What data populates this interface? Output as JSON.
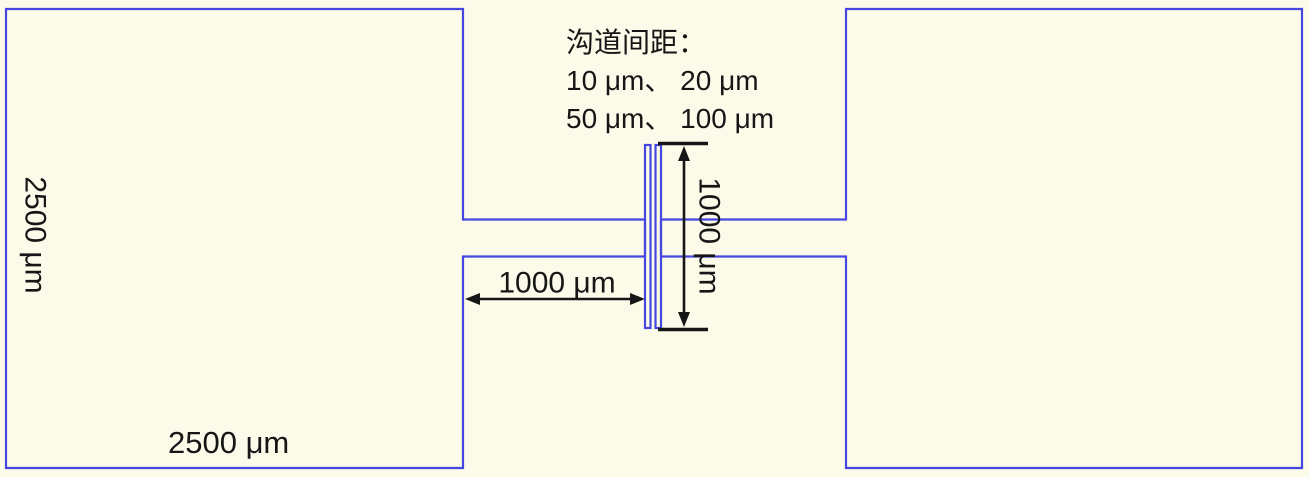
{
  "figure": {
    "title_hint": "microfabricated two-pad electrode layout with channel gap",
    "colors": {
      "background": "#fcfae8",
      "outline": "#4646e0",
      "ink": "#161616"
    }
  },
  "note": {
    "line1": "沟道间距：",
    "line2": "10 μm、 20 μm",
    "line3": "50 μm、 100 μm"
  },
  "dimensions": {
    "pad_height": "2500 μm",
    "pad_width": "2500 μm",
    "arm_length": "1000 μm",
    "channel_length": "1000 μm"
  }
}
